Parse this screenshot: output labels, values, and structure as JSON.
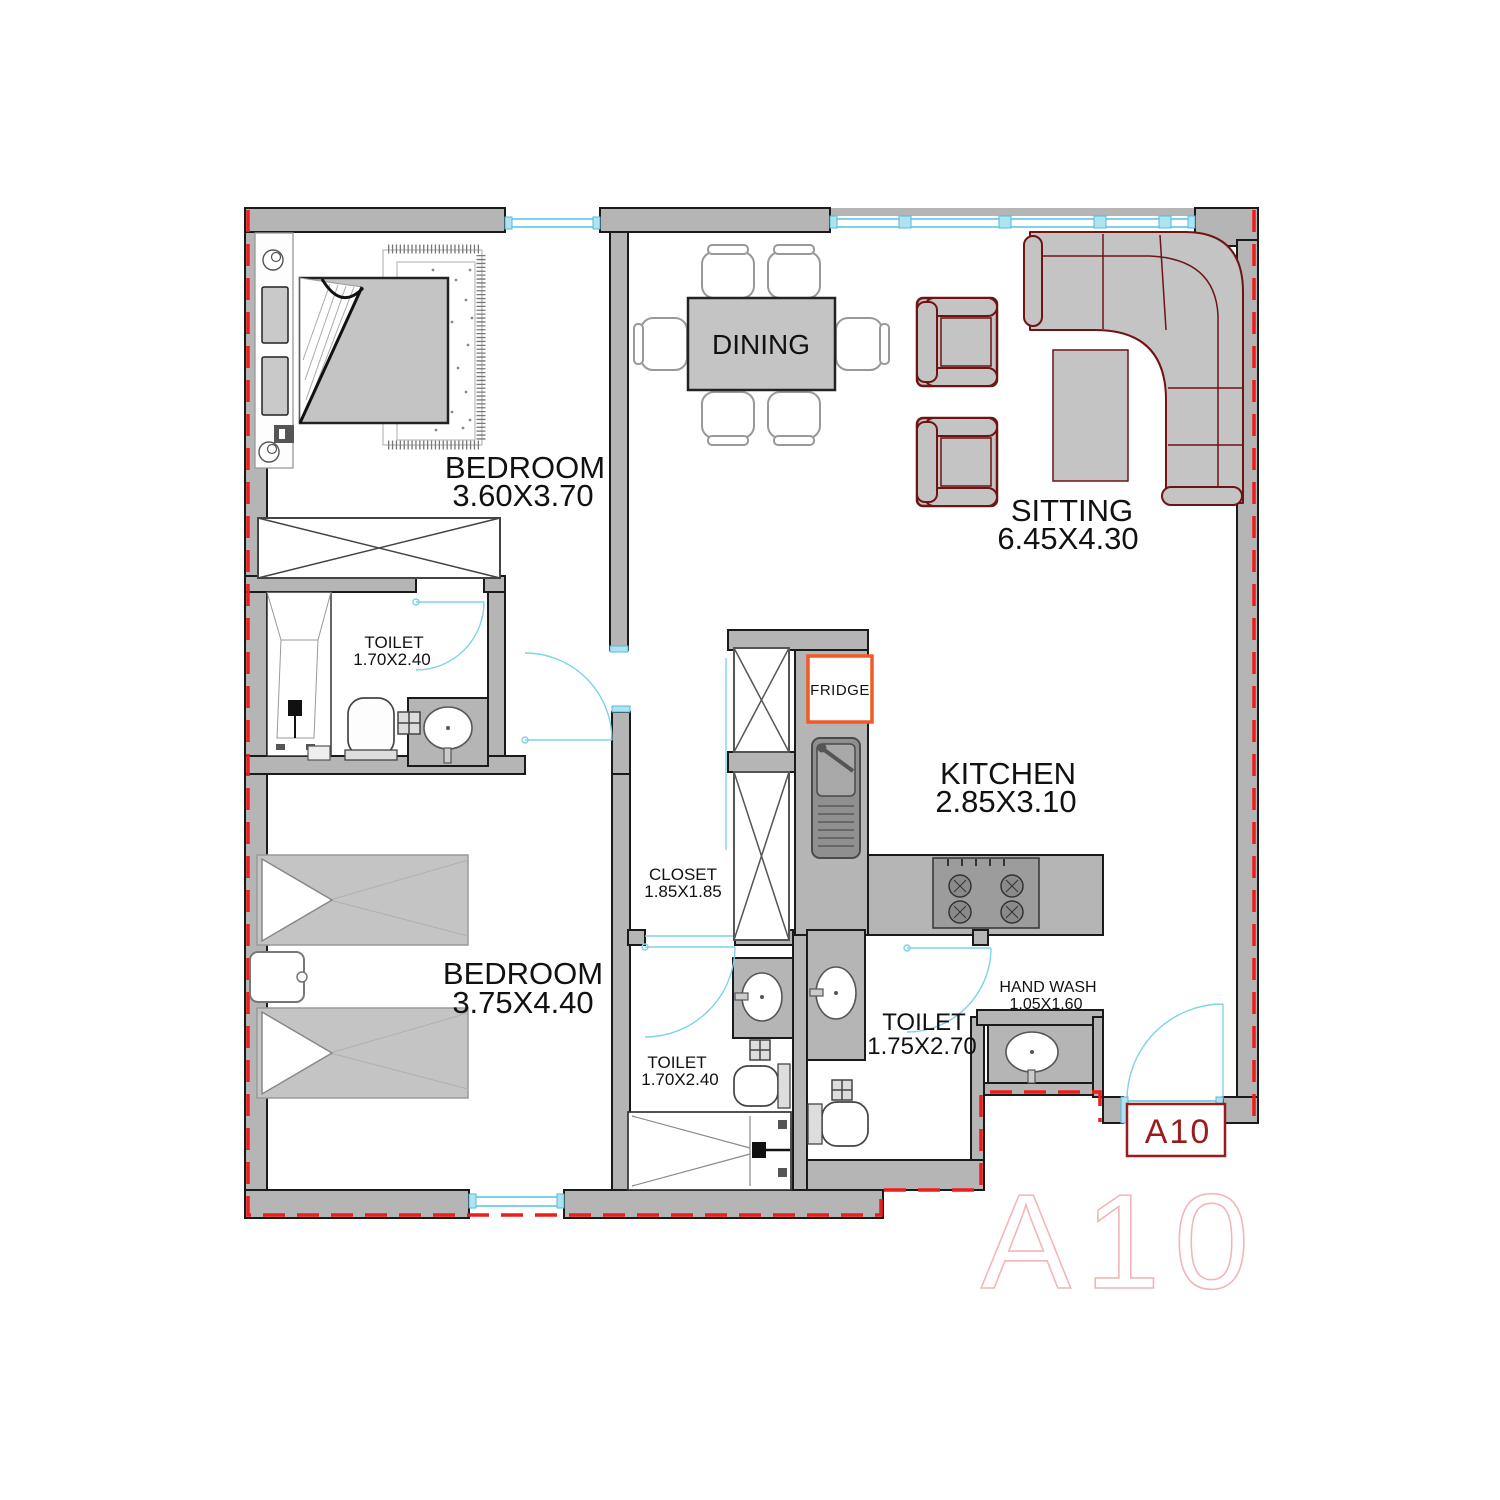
{
  "unit": {
    "code": "A10",
    "watermark": "A10"
  },
  "colors": {
    "wall_fill": "#b5b5b5",
    "wall_stroke": "#1a1a1a",
    "boundary_red": "#ee1c1c",
    "opening_cyan": "#7fd2ec",
    "furniture_gray": "#c4c4c4",
    "furniture_dark_red": "#6e1414",
    "fridge_orange": "#f05a28",
    "unit_label_red": "#9b1b1b",
    "watermark_pink": "#f2b6b6"
  },
  "rooms": {
    "bedroom1": {
      "name": "BEDROOM",
      "dim": "3.60X3.70"
    },
    "dining": {
      "name": "DINING"
    },
    "sitting": {
      "name": "SITTING",
      "dim": "6.45X4.30"
    },
    "toilet1": {
      "name": "TOILET",
      "dim": "1.70X2.40"
    },
    "closet": {
      "name": "CLOSET",
      "dim": "1.85X1.85"
    },
    "kitchen": {
      "name": "KITCHEN",
      "dim": "2.85X3.10"
    },
    "fridge": {
      "name": "FRIDGE"
    },
    "bedroom2": {
      "name": "BEDROOM",
      "dim": "3.75X4.40"
    },
    "toilet2": {
      "name": "TOILET",
      "dim": "1.70X2.40"
    },
    "toilet3": {
      "name": "TOILET",
      "dim": "1.75X2.70"
    },
    "handwash": {
      "name": "HAND WASH",
      "dim": "1.05X1.60"
    }
  }
}
